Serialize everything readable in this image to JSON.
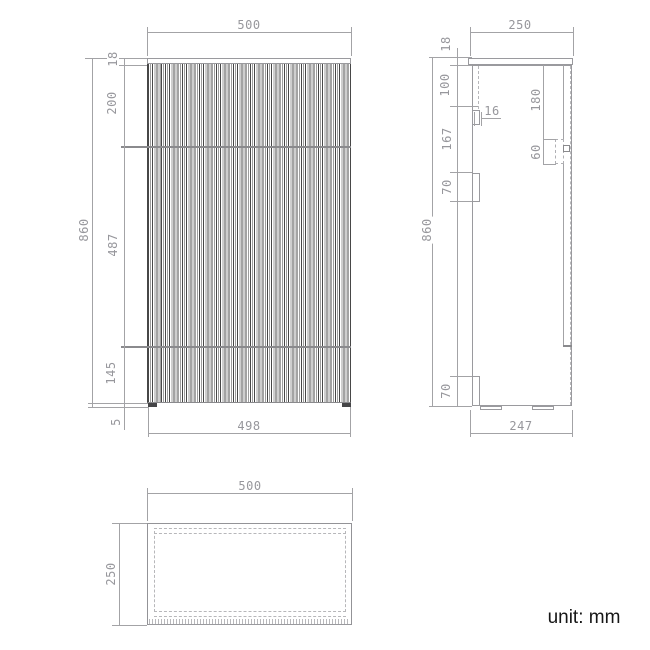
{
  "unit_note": "unit: mm",
  "colors": {
    "line": "#a3a3a6",
    "dim_text": "#97979c",
    "slat_dark": "#474747",
    "note_text": "#161616"
  },
  "views": {
    "front": {
      "label": "front elevation",
      "dims": {
        "width": "500",
        "overall_height": "860",
        "top_thickness": "18",
        "upper_section": "200",
        "middle_section": "487",
        "lower_section": "145",
        "plinth_gap": "5",
        "body_width": "498"
      }
    },
    "side": {
      "label": "side elevation",
      "dims": {
        "depth": "250",
        "top_thickness": "18",
        "rail_offset": "100",
        "panel_thickness": "16",
        "rail_spacing": "167",
        "upper_bracket_height": "70",
        "lower_bracket_height": "70",
        "overall_height": "860",
        "catch_offset": "180",
        "catch_height": "60",
        "body_depth": "247"
      }
    },
    "plan": {
      "label": "top view",
      "dims": {
        "width": "500",
        "depth": "250"
      }
    }
  }
}
